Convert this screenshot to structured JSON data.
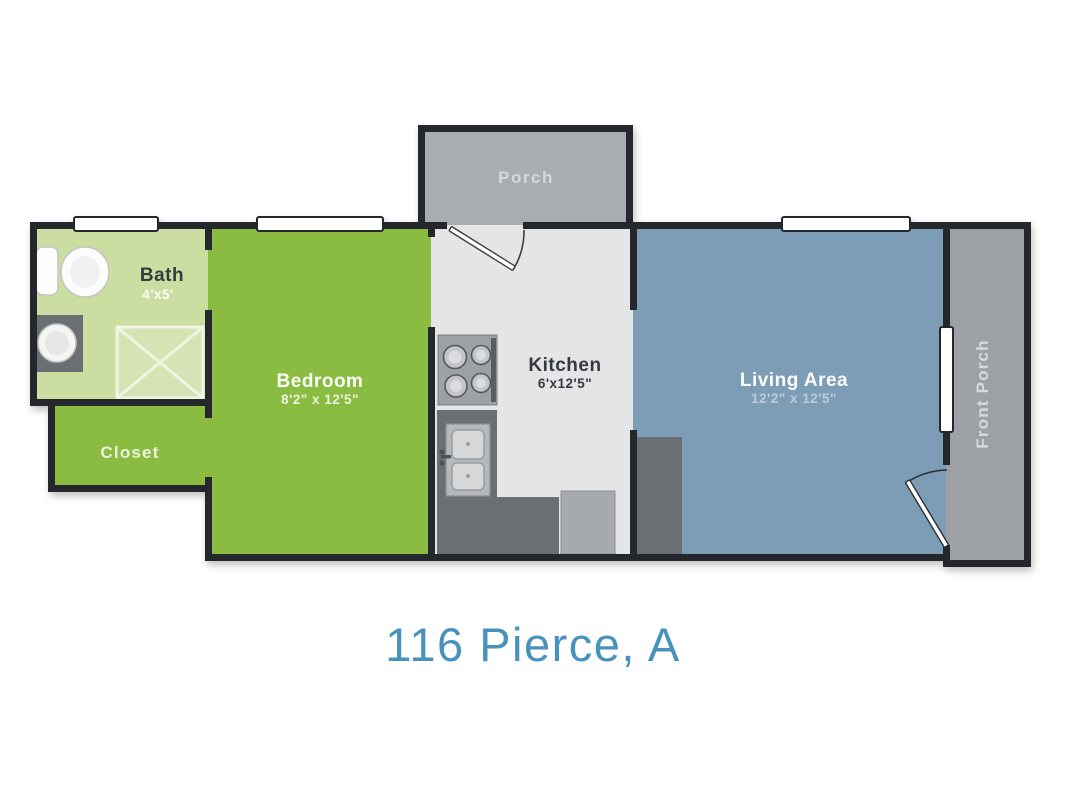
{
  "title": "116 Pierce, A",
  "rooms": {
    "porch": {
      "label": "Porch"
    },
    "bath": {
      "label": "Bath",
      "dims": "4'x5'"
    },
    "closet": {
      "label": "Closet"
    },
    "bedroom": {
      "label": "Bedroom",
      "dims": "8'2\" x 12'5\""
    },
    "kitchen": {
      "label": "Kitchen",
      "dims": "6'x12'5\""
    },
    "living_area": {
      "label": "Living Area",
      "dims": "12'2\" x 12'5\""
    },
    "front_porch": {
      "label": "Front Porch"
    }
  },
  "colors": {
    "wall": "#24282c",
    "bath_floor": "#ccdda1",
    "shower_fill": "#d7e3b4",
    "shower_line": "#f0f4e2",
    "green_floor": "#8abc41",
    "kitchen_floor": "#e4e5e7",
    "living_floor": "#7d9cb6",
    "porch_floor": "#a9acb0",
    "front_porch_floor": "#9da0a5",
    "counter": "#6b6e72",
    "appliance": "#a6a9ad",
    "stove": "#9da0a4",
    "window_fill": "#ffffff",
    "door_fill": "#ffffff",
    "title_text": "#4a92be",
    "label_light": "#fbfdfa",
    "label_green_dims": "#eef4df",
    "label_dark": "#353a41",
    "label_porch_text": "#d6d8da",
    "label_living_dims": "#bdcbd8"
  }
}
